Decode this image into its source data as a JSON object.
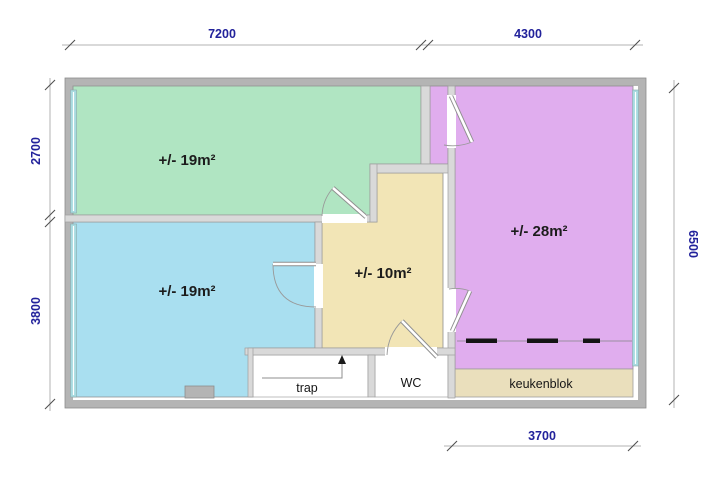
{
  "colors": {
    "room_green": "#b0e5c2",
    "room_blue": "#a9dff0",
    "room_purple": "#e0adee",
    "room_hall": "#f2e5b6",
    "kitchen_unit": "#eadfbc",
    "window": "#a8dbe0",
    "dim_text": "#22229b"
  },
  "rooms": [
    {
      "name": "room-top-left",
      "label": "+/- 19m²"
    },
    {
      "name": "room-bottom-left",
      "label": "+/- 19m²"
    },
    {
      "name": "hall",
      "label": "+/- 10m²"
    },
    {
      "name": "room-right",
      "label": "+/- 28m²"
    }
  ],
  "labels": {
    "stairs": "trap",
    "toilet": "WC",
    "kitchen": "keukenblok"
  },
  "dimensions": {
    "top_left": "7200",
    "top_right": "4300",
    "left_upper": "2700",
    "left_lower": "3800",
    "right_side": "6500",
    "bottom": "3700"
  }
}
